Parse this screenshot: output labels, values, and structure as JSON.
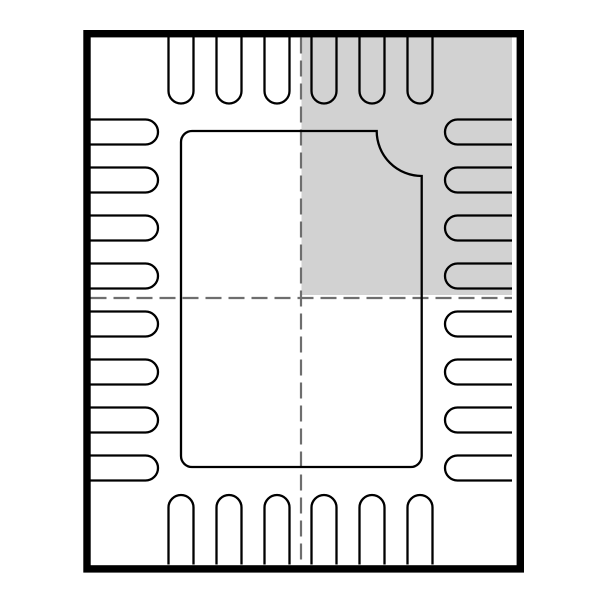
{
  "drawing": {
    "title": "qfn-28-package-outline",
    "canvas": {
      "width": 600,
      "height": 600,
      "background": "#ffffff"
    },
    "colors": {
      "outline": "#000000",
      "highlight_fill": "#d2d2d2",
      "centerline": "#6e6e6e"
    },
    "outer_border": {
      "x": 87,
      "y": 33.7,
      "width": 433.3,
      "height": 535.2,
      "stroke_width": 7.4
    },
    "highlight_region": {
      "x": 301.5,
      "y": 37,
      "width": 210.5,
      "height": 258
    },
    "centerlines": {
      "stroke_width": 2.2,
      "dash": "16 7",
      "vertical": {
        "x": 301,
        "y1": 37.5,
        "y2": 564.5
      },
      "horizontal": {
        "y": 298,
        "x1": 90.5,
        "x2": 512
      }
    },
    "pins": {
      "stroke_width": 2.3,
      "pad_width": 25,
      "tip_radius": 12.5,
      "top": {
        "count": 6,
        "centers_x": [
          181,
          229,
          277,
          324,
          372,
          420
        ],
        "root_y": 37,
        "tip_y": 103.5
      },
      "bottom": {
        "count": 6,
        "centers_x": [
          181,
          229,
          277,
          324,
          372,
          420
        ],
        "root_y": 564.5,
        "tip_y": 495
      },
      "left": {
        "count": 8,
        "centers_y": [
          132,
          180,
          228,
          276,
          324,
          372,
          420,
          468
        ],
        "root_x": 90.5,
        "tip_x": 158
      },
      "right": {
        "count": 8,
        "centers_y": [
          132,
          180,
          228,
          276,
          324,
          372,
          420,
          468
        ],
        "root_x": 512,
        "tip_x": 445
      }
    },
    "center_pad": {
      "x": 181,
      "y": 131,
      "width": 240.7,
      "height": 336,
      "corner_radius": 11,
      "pin1_notch_radius": 45,
      "notch_corner": "top-right",
      "stroke_width": 2.3
    }
  }
}
